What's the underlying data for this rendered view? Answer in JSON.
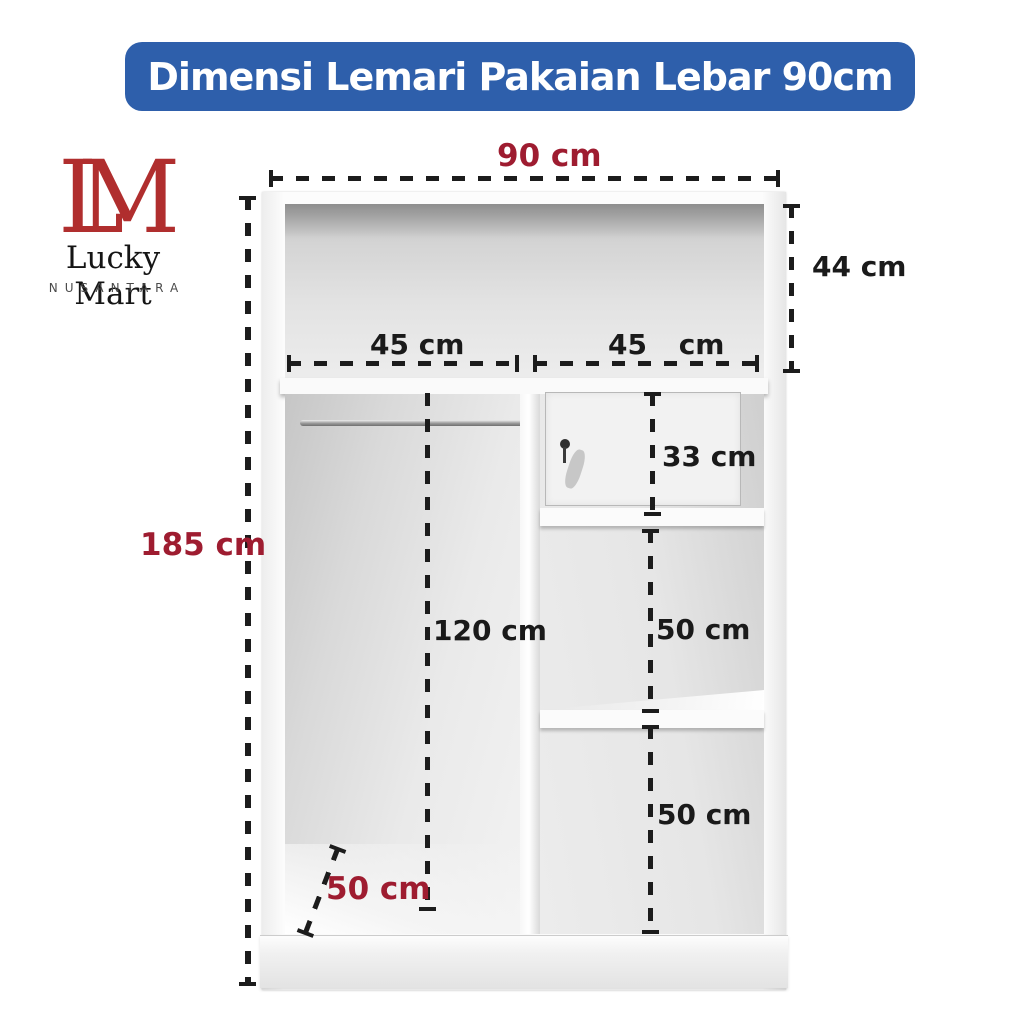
{
  "banner": {
    "title": "Dimensi Lemari Pakaian Lebar 90cm",
    "bg_color": "#2E5FAB",
    "text_color": "#FFFFFF"
  },
  "logo": {
    "monogram_l": "L",
    "monogram_m": "M",
    "monogram_color": "#B02E2E",
    "name": "Lucky Mart",
    "subtitle": "NUSANTARA"
  },
  "colors": {
    "accent_red": "#9E1C30",
    "dimension_text": "#1A1A1A",
    "dash_line": "#1C1C1C"
  },
  "dimensions": {
    "total_width": "90 cm",
    "top_section_height": "44 cm",
    "left_section_width": "45 cm",
    "right_section_width": "45 cm",
    "locker_height": "33 cm",
    "total_height": "185 cm",
    "hanging_space_height": "120 cm",
    "upper_shelf_height": "50 cm",
    "lower_shelf_height": "50 cm",
    "depth": "50 cm"
  }
}
